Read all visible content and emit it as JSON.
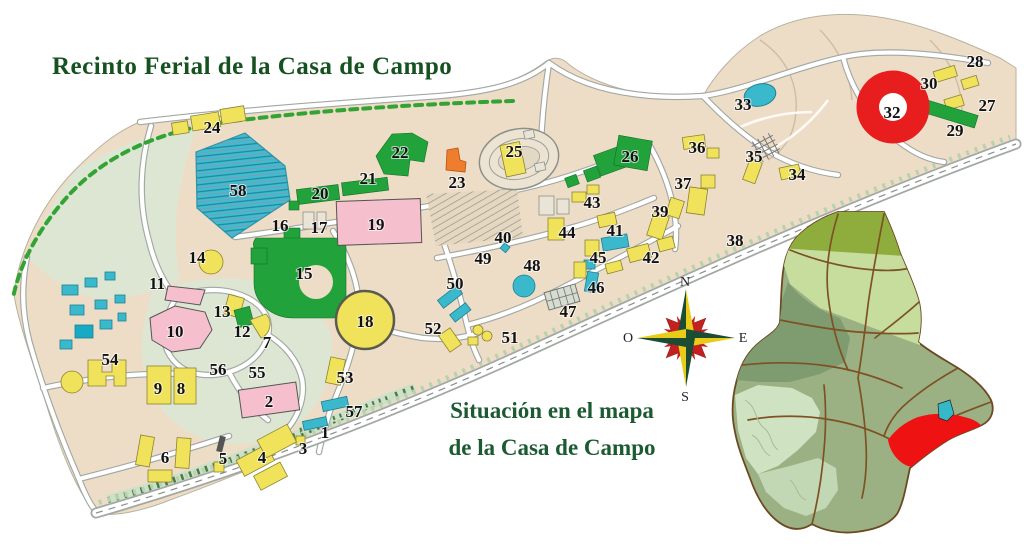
{
  "title": "Recinto Ferial de la Casa de Campo",
  "caption": {
    "line1": "Situación en el mapa",
    "line2": "de la Casa de Campo"
  },
  "compass": {
    "north": "N",
    "south": "S",
    "east": "E",
    "west": "O"
  },
  "palette": {
    "beige": "#eeddc6",
    "sage": "#dce6d2",
    "road_fill": "#ffffff",
    "road_casing": "#a2a8a4",
    "yellow": "#f1e25c",
    "cyan": "#3ab9cd",
    "pink": "#f6bfce",
    "green": "#21a23b",
    "orange": "#ef7d2e",
    "red": "#e81d1d",
    "dash_green": "#33a433",
    "title_green": "#15521f",
    "caption_green": "#1c5a31",
    "marker_ink": "#111111",
    "inset_base": "#9cb183",
    "inset_olive": "#8fad3c",
    "inset_light": "#c6dd9e",
    "inset_dark": "#7f9c71",
    "inset_pale": "#cfe3c2",
    "inset_path": "#7d5224",
    "inset_red": "#ee1212",
    "inset_lake": "#35b8c8",
    "compass_dark": "#1c4c34",
    "compass_yellow": "#e8cc18",
    "compass_red": "#c42020"
  },
  "map": {
    "markers": [
      {
        "n": "1",
        "x": 325,
        "y": 432
      },
      {
        "n": "2",
        "x": 269,
        "y": 401
      },
      {
        "n": "3",
        "x": 303,
        "y": 448
      },
      {
        "n": "4",
        "x": 262,
        "y": 457
      },
      {
        "n": "5",
        "x": 223,
        "y": 458
      },
      {
        "n": "6",
        "x": 165,
        "y": 457
      },
      {
        "n": "7",
        "x": 267,
        "y": 342
      },
      {
        "n": "8",
        "x": 181,
        "y": 388
      },
      {
        "n": "9",
        "x": 158,
        "y": 388
      },
      {
        "n": "10",
        "x": 175,
        "y": 331
      },
      {
        "n": "11",
        "x": 157,
        "y": 283
      },
      {
        "n": "12",
        "x": 242,
        "y": 331
      },
      {
        "n": "13",
        "x": 222,
        "y": 311
      },
      {
        "n": "14",
        "x": 197,
        "y": 257
      },
      {
        "n": "15",
        "x": 304,
        "y": 273
      },
      {
        "n": "16",
        "x": 280,
        "y": 225
      },
      {
        "n": "17",
        "x": 319,
        "y": 227
      },
      {
        "n": "18",
        "x": 365,
        "y": 321
      },
      {
        "n": "19",
        "x": 376,
        "y": 224
      },
      {
        "n": "20",
        "x": 320,
        "y": 193
      },
      {
        "n": "21",
        "x": 368,
        "y": 178
      },
      {
        "n": "22",
        "x": 400,
        "y": 152
      },
      {
        "n": "23",
        "x": 457,
        "y": 182
      },
      {
        "n": "24",
        "x": 212,
        "y": 127
      },
      {
        "n": "25",
        "x": 514,
        "y": 151
      },
      {
        "n": "26",
        "x": 630,
        "y": 156
      },
      {
        "n": "27",
        "x": 987,
        "y": 105
      },
      {
        "n": "28",
        "x": 975,
        "y": 61
      },
      {
        "n": "29",
        "x": 955,
        "y": 130
      },
      {
        "n": "30",
        "x": 929,
        "y": 83
      },
      {
        "n": "32",
        "x": 892,
        "y": 112
      },
      {
        "n": "33",
        "x": 743,
        "y": 104
      },
      {
        "n": "34",
        "x": 797,
        "y": 174
      },
      {
        "n": "35",
        "x": 754,
        "y": 156
      },
      {
        "n": "36",
        "x": 697,
        "y": 147
      },
      {
        "n": "37",
        "x": 683,
        "y": 183
      },
      {
        "n": "38",
        "x": 735,
        "y": 240
      },
      {
        "n": "39",
        "x": 660,
        "y": 211
      },
      {
        "n": "40",
        "x": 503,
        "y": 237
      },
      {
        "n": "41",
        "x": 615,
        "y": 230
      },
      {
        "n": "42",
        "x": 651,
        "y": 257
      },
      {
        "n": "43",
        "x": 592,
        "y": 202
      },
      {
        "n": "44",
        "x": 567,
        "y": 232
      },
      {
        "n": "45",
        "x": 598,
        "y": 257
      },
      {
        "n": "46",
        "x": 596,
        "y": 287
      },
      {
        "n": "47",
        "x": 568,
        "y": 311
      },
      {
        "n": "48",
        "x": 532,
        "y": 265
      },
      {
        "n": "49",
        "x": 483,
        "y": 258
      },
      {
        "n": "50",
        "x": 455,
        "y": 283
      },
      {
        "n": "51",
        "x": 510,
        "y": 337
      },
      {
        "n": "52",
        "x": 433,
        "y": 328
      },
      {
        "n": "53",
        "x": 345,
        "y": 377
      },
      {
        "n": "54",
        "x": 110,
        "y": 359
      },
      {
        "n": "55",
        "x": 257,
        "y": 372
      },
      {
        "n": "56",
        "x": 218,
        "y": 369
      },
      {
        "n": "57",
        "x": 354,
        "y": 411
      },
      {
        "n": "58",
        "x": 238,
        "y": 190
      }
    ]
  }
}
